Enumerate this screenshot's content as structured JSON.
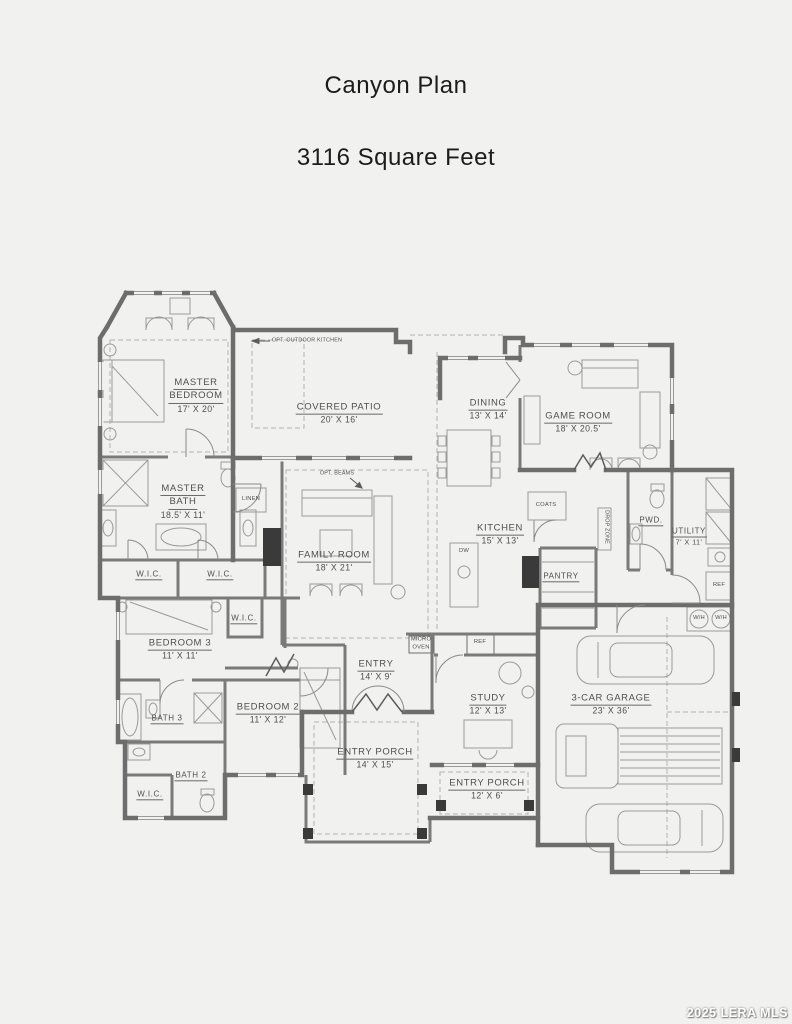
{
  "title": "Canyon Plan",
  "subtitle": "3116 Square Feet",
  "watermark": "2025 LERA MLS",
  "colors": {
    "background": "#f1f1ef",
    "wall": "#6d6d6d",
    "interior_wall": "#7a7a7a",
    "furniture_line": "#9a9a9a",
    "dashed_line": "#b3b3b3",
    "label_text": "#4f4f4f",
    "watermark_text": "#ffffff"
  },
  "plan": {
    "labels": [
      {
        "id": "master-bedroom",
        "lines": [
          "MASTER",
          "BEDROOM"
        ],
        "dims": "17' X 20'",
        "x": 196,
        "y": 396,
        "size": "lg",
        "u": true
      },
      {
        "id": "covered-patio",
        "lines": [
          "COVERED PATIO"
        ],
        "dims": "20' X 16'",
        "x": 339,
        "y": 414,
        "size": "lg",
        "u": true
      },
      {
        "id": "dining",
        "lines": [
          "DINING"
        ],
        "dims": "13' X 14'",
        "x": 488,
        "y": 410,
        "size": "lg",
        "u": true
      },
      {
        "id": "game-room",
        "lines": [
          "GAME ROOM"
        ],
        "dims": "18' X 20.5'",
        "x": 578,
        "y": 423,
        "size": "lg",
        "u": true
      },
      {
        "id": "opt-outdoor-kitchen",
        "lines": [
          "OPT. OUTDOOR KITCHEN"
        ],
        "x": 307,
        "y": 341,
        "size": "xs",
        "u": false
      },
      {
        "id": "opt-beams",
        "lines": [
          "OPT. BEAMS"
        ],
        "x": 337,
        "y": 474,
        "size": "xs",
        "u": false
      },
      {
        "id": "master-bath",
        "lines": [
          "MASTER",
          "BATH"
        ],
        "dims": "18.5' X 11'",
        "x": 183,
        "y": 502,
        "size": "lg",
        "u": true
      },
      {
        "id": "linen",
        "lines": [
          "LINEN"
        ],
        "x": 251,
        "y": 500,
        "size": "sm",
        "u": false
      },
      {
        "id": "pwd",
        "lines": [
          "PWD."
        ],
        "x": 651,
        "y": 521,
        "size": "md",
        "u": true
      },
      {
        "id": "utility",
        "lines": [
          "UTILITY"
        ],
        "dims": "7' X 11'",
        "x": 689,
        "y": 537,
        "size": "md",
        "u": true
      },
      {
        "id": "wic-master-left",
        "lines": [
          "W.I.C."
        ],
        "x": 149,
        "y": 575,
        "size": "md",
        "u": true
      },
      {
        "id": "wic-master-right",
        "lines": [
          "W.I.C."
        ],
        "x": 220,
        "y": 575,
        "size": "md",
        "u": true
      },
      {
        "id": "family-room",
        "lines": [
          "FAMILY ROOM"
        ],
        "dims": "18' X 21'",
        "x": 334,
        "y": 562,
        "size": "lg",
        "u": true
      },
      {
        "id": "kitchen",
        "lines": [
          "KITCHEN"
        ],
        "dims": "15' X 13'",
        "x": 500,
        "y": 535,
        "size": "lg",
        "u": true
      },
      {
        "id": "coats",
        "lines": [
          "COATS"
        ],
        "x": 546,
        "y": 506,
        "size": "sm",
        "u": false
      },
      {
        "id": "pantry",
        "lines": [
          "PANTRY"
        ],
        "x": 561,
        "y": 577,
        "size": "md",
        "u": true
      },
      {
        "id": "drop-zone",
        "lines": [
          "DROP ZONE"
        ],
        "x": 606,
        "y": 527,
        "size": "xs",
        "u": false,
        "rot": 90
      },
      {
        "id": "dw",
        "lines": [
          "DW"
        ],
        "x": 464,
        "y": 552,
        "size": "sm",
        "u": false
      },
      {
        "id": "wic-bedroom3",
        "lines": [
          "W.I.C."
        ],
        "x": 244,
        "y": 619,
        "size": "md",
        "u": true
      },
      {
        "id": "bedroom-3",
        "lines": [
          "BEDROOM 3"
        ],
        "dims": "11' X 11'",
        "x": 180,
        "y": 650,
        "size": "lg",
        "u": true
      },
      {
        "id": "micro-oven",
        "lines": [
          "MICRO",
          "OVEN"
        ],
        "x": 421,
        "y": 644,
        "size": "sm",
        "u": false
      },
      {
        "id": "ref-kitchen",
        "lines": [
          "REF"
        ],
        "x": 480,
        "y": 643,
        "size": "sm",
        "u": false
      },
      {
        "id": "ref-utility",
        "lines": [
          "REF"
        ],
        "x": 719,
        "y": 586,
        "size": "sm",
        "u": false
      },
      {
        "id": "wh-left",
        "lines": [
          "W/H"
        ],
        "x": 699,
        "y": 619,
        "size": "sm",
        "u": false
      },
      {
        "id": "wh-right",
        "lines": [
          "W/H"
        ],
        "x": 721,
        "y": 619,
        "size": "sm",
        "u": false
      },
      {
        "id": "entry",
        "lines": [
          "ENTRY"
        ],
        "dims": "14' X 9'",
        "x": 376,
        "y": 671,
        "size": "lg",
        "u": true
      },
      {
        "id": "bath-3",
        "lines": [
          "BATH 3"
        ],
        "x": 167,
        "y": 719,
        "size": "md",
        "u": true
      },
      {
        "id": "bedroom-2",
        "lines": [
          "BEDROOM 2"
        ],
        "dims": "11' X 12'",
        "x": 268,
        "y": 714,
        "size": "lg",
        "u": true
      },
      {
        "id": "study",
        "lines": [
          "STUDY"
        ],
        "dims": "12' X 13'",
        "x": 488,
        "y": 705,
        "size": "lg",
        "u": true
      },
      {
        "id": "garage",
        "lines": [
          "3-CAR GARAGE"
        ],
        "dims": "23' X 36'",
        "x": 611,
        "y": 705,
        "size": "lg",
        "u": true
      },
      {
        "id": "entry-porch-main",
        "lines": [
          "ENTRY PORCH"
        ],
        "dims": "14' X 15'",
        "x": 375,
        "y": 759,
        "size": "lg",
        "u": true
      },
      {
        "id": "bath-2",
        "lines": [
          "BATH 2"
        ],
        "x": 191,
        "y": 776,
        "size": "md",
        "u": true
      },
      {
        "id": "entry-porch-side",
        "lines": [
          "ENTRY PORCH"
        ],
        "dims": "12' X 6'",
        "x": 487,
        "y": 790,
        "size": "lg",
        "u": true
      },
      {
        "id": "wic-bath2",
        "lines": [
          "W.I.C."
        ],
        "x": 150,
        "y": 795,
        "size": "md",
        "u": true
      }
    ]
  }
}
